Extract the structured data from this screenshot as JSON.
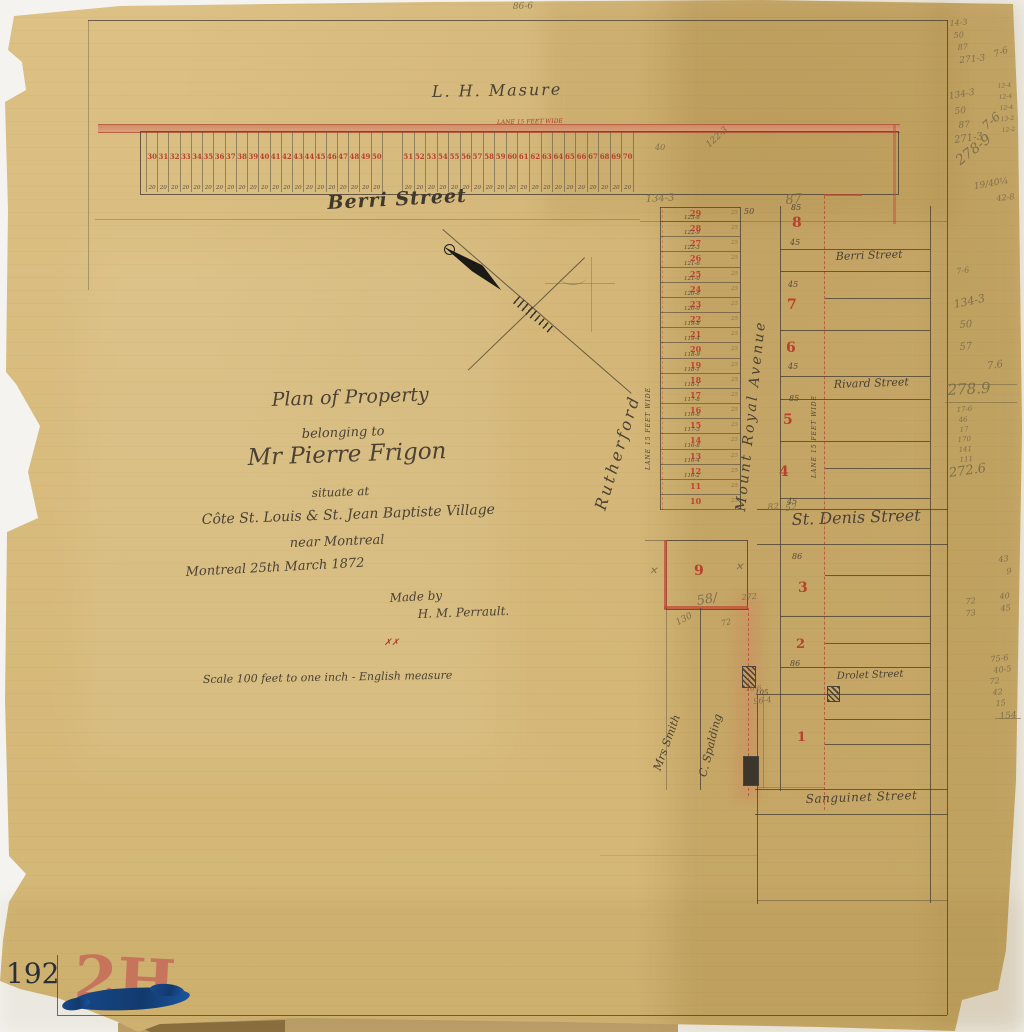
{
  "document": {
    "catalog_number": "192",
    "stamp": "2H"
  },
  "strip": {
    "lane_label": "LANE 15 FEET WIDE",
    "width_label": "20",
    "lots_west": [
      "30",
      "31",
      "32",
      "33",
      "34",
      "35",
      "36",
      "37",
      "38",
      "39",
      "40",
      "41",
      "42",
      "43",
      "44",
      "45",
      "46",
      "47",
      "48",
      "49",
      "50"
    ],
    "lots_east": [
      "51",
      "52",
      "53",
      "54",
      "55",
      "56",
      "57",
      "58",
      "59",
      "60",
      "61",
      "62",
      "63",
      "64",
      "65",
      "66",
      "67",
      "68",
      "69",
      "70"
    ]
  },
  "column": {
    "lane_label": "LANE 15 FEET WIDE",
    "depth_label": "25",
    "lots": [
      {
        "n": "29",
        "d": "123-6"
      },
      {
        "n": "28",
        "d": "122-9"
      },
      {
        "n": "27",
        "d": "122-3"
      },
      {
        "n": "26",
        "d": "121-6"
      },
      {
        "n": "25",
        "d": "121-0"
      },
      {
        "n": "24",
        "d": "120-6"
      },
      {
        "n": "23",
        "d": "120-0"
      },
      {
        "n": "22",
        "d": "119-8"
      },
      {
        "n": "21",
        "d": "119-4"
      },
      {
        "n": "20",
        "d": "118-9"
      },
      {
        "n": "19",
        "d": "118-1"
      },
      {
        "n": "18",
        "d": "118-1"
      },
      {
        "n": "17",
        "d": "117-8"
      },
      {
        "n": "16",
        "d": "116-6"
      },
      {
        "n": "15",
        "d": "117-3"
      },
      {
        "n": "14",
        "d": "116-8"
      },
      {
        "n": "13",
        "d": "116-4"
      },
      {
        "n": "12",
        "d": "116-2"
      },
      {
        "n": "11",
        "d": ""
      },
      {
        "n": "10",
        "d": ""
      }
    ]
  },
  "labels": [
    {
      "t": "L. H. Masure",
      "x": 432,
      "y": 100,
      "s": 16,
      "r": -1,
      "ls": 2,
      "c": "ink",
      "n": "owner-label-masure"
    },
    {
      "t": "LANE 15 FEET WIDE",
      "x": 497,
      "y": 126,
      "s": 6,
      "r": -1,
      "c": "red",
      "n": "strip-lane-label"
    },
    {
      "t": "Berri Street",
      "x": 328,
      "y": 213,
      "s": 19,
      "r": -3,
      "c": "inkb",
      "n": "street-berri-main"
    },
    {
      "t": "Plan of Property",
      "x": 272,
      "y": 410,
      "s": 19,
      "r": -2,
      "c": "ink",
      "n": "title-line-1"
    },
    {
      "t": "belonging to",
      "x": 302,
      "y": 441,
      "s": 13,
      "r": -2,
      "c": "ink",
      "n": "title-line-2"
    },
    {
      "t": "Mr Pierre Frigon",
      "x": 248,
      "y": 470,
      "s": 23,
      "r": -2,
      "c": "ink",
      "n": "title-line-3"
    },
    {
      "t": "situate at",
      "x": 312,
      "y": 499,
      "s": 12,
      "r": -2,
      "c": "ink",
      "n": "title-line-4"
    },
    {
      "t": "Côte St. Louis & St. Jean Baptiste Village",
      "x": 202,
      "y": 527,
      "s": 14,
      "r": -2,
      "c": "ink",
      "n": "title-line-5"
    },
    {
      "t": "near Montreal",
      "x": 290,
      "y": 550,
      "s": 13,
      "r": -2,
      "c": "ink",
      "n": "title-line-6"
    },
    {
      "t": "Montreal 25th March 1872",
      "x": 186,
      "y": 579,
      "s": 13,
      "r": -3,
      "c": "ink",
      "n": "date-line"
    },
    {
      "t": "Made by",
      "x": 390,
      "y": 604,
      "s": 12,
      "r": -3,
      "c": "ink",
      "n": "made-by-label"
    },
    {
      "t": "H. M. Perrault.",
      "x": 418,
      "y": 620,
      "s": 12,
      "r": -2,
      "c": "ink",
      "n": "maker-name"
    },
    {
      "t": "✗✗",
      "x": 384,
      "y": 648,
      "s": 9,
      "r": 0,
      "c": "red",
      "n": "red-check-marks"
    },
    {
      "t": "Scale 100 feet to one inch - English measure",
      "x": 203,
      "y": 685,
      "s": 11,
      "r": -1,
      "c": "ink",
      "n": "scale-note"
    },
    {
      "t": "Rutherford",
      "x": 608,
      "y": 512,
      "s": 16,
      "r": -73,
      "ls": 3,
      "c": "ink",
      "n": "owner-rutherford"
    },
    {
      "t": "Mount Royal Avenue",
      "x": 748,
      "y": 512,
      "s": 14,
      "r": -84,
      "ls": 2.5,
      "c": "ink",
      "n": "street-mount-royal-avenue"
    },
    {
      "t": "LANE 15 FEET WIDE",
      "x": 652,
      "y": 470,
      "s": 6,
      "r": -90,
      "ls": 1,
      "c": "ink",
      "n": "column-lane-label"
    },
    {
      "t": "LANE 15 FEET WIDE",
      "x": 818,
      "y": 478,
      "s": 6,
      "r": -90,
      "ls": 1,
      "c": "ink",
      "n": "east-lane-label"
    },
    {
      "t": "Mrs Smith",
      "x": 662,
      "y": 772,
      "s": 11,
      "r": -70,
      "c": "ink",
      "n": "owner-mrs-smith"
    },
    {
      "t": "C. Spalding",
      "x": 708,
      "y": 778,
      "s": 11,
      "r": -76,
      "c": "ink",
      "n": "owner-c-spalding"
    },
    {
      "t": "Berri Street",
      "x": 836,
      "y": 262,
      "s": 11,
      "r": -2,
      "c": "ink",
      "n": "street-berri-east"
    },
    {
      "t": "Rivard Street",
      "x": 834,
      "y": 390,
      "s": 11,
      "r": -2,
      "c": "ink",
      "n": "street-rivard"
    },
    {
      "t": "St. Denis Street",
      "x": 792,
      "y": 528,
      "s": 16,
      "r": -2,
      "c": "ink",
      "n": "street-st-denis"
    },
    {
      "t": "Drolet Street",
      "x": 837,
      "y": 682,
      "s": 10,
      "r": -2,
      "c": "ink",
      "n": "street-drolet"
    },
    {
      "t": "Sanguinet Street",
      "x": 806,
      "y": 805,
      "s": 12,
      "r": -2,
      "ls": 0.5,
      "c": "ink",
      "n": "street-sanguinet"
    },
    {
      "t": "9",
      "x": 694,
      "y": 578,
      "s": 14,
      "r": 0,
      "c": "rnum",
      "n": "lot-9"
    },
    {
      "t": "8",
      "x": 792,
      "y": 230,
      "s": 14,
      "r": 0,
      "c": "rnum",
      "n": "lot-8"
    },
    {
      "t": "7",
      "x": 787,
      "y": 312,
      "s": 14,
      "r": 0,
      "c": "rnum",
      "n": "lot-7"
    },
    {
      "t": "6",
      "x": 786,
      "y": 355,
      "s": 14,
      "r": 0,
      "c": "rnum",
      "n": "lot-6"
    },
    {
      "t": "5",
      "x": 783,
      "y": 427,
      "s": 14,
      "r": 0,
      "c": "rnum",
      "n": "lot-5"
    },
    {
      "t": "4",
      "x": 779,
      "y": 479,
      "s": 14,
      "r": 0,
      "c": "rnum",
      "n": "lot-4"
    },
    {
      "t": "3",
      "x": 798,
      "y": 595,
      "s": 14,
      "r": 0,
      "c": "rnum",
      "n": "lot-3"
    },
    {
      "t": "2",
      "x": 796,
      "y": 651,
      "s": 13,
      "r": 0,
      "c": "rnum",
      "n": "lot-2"
    },
    {
      "t": "1",
      "x": 797,
      "y": 744,
      "s": 13,
      "r": 0,
      "c": "rnum",
      "n": "lot-1"
    },
    {
      "t": "85",
      "x": 791,
      "y": 212,
      "s": 8,
      "r": 0,
      "c": "dim",
      "n": "dim-85"
    },
    {
      "t": "45",
      "x": 790,
      "y": 247,
      "s": 8,
      "r": 0,
      "c": "dim",
      "n": "dim-45"
    },
    {
      "t": "45",
      "x": 788,
      "y": 289,
      "s": 8,
      "r": 0,
      "c": "dim",
      "n": "dim-45"
    },
    {
      "t": "45",
      "x": 788,
      "y": 371,
      "s": 8,
      "r": 0,
      "c": "dim",
      "n": "dim-45"
    },
    {
      "t": "85",
      "x": 789,
      "y": 403,
      "s": 8,
      "r": 0,
      "c": "dim",
      "n": "dim-85"
    },
    {
      "t": "45",
      "x": 787,
      "y": 506,
      "s": 8,
      "r": 0,
      "c": "dim",
      "n": "dim-45"
    },
    {
      "t": "86",
      "x": 792,
      "y": 561,
      "s": 8,
      "r": 0,
      "c": "dim",
      "n": "dim-86"
    },
    {
      "t": "86",
      "x": 790,
      "y": 668,
      "s": 8,
      "r": 0,
      "c": "dim",
      "n": "dim-86"
    },
    {
      "t": "105",
      "x": 755,
      "y": 697,
      "s": 7,
      "r": 0,
      "c": "dim",
      "n": "dim-105"
    },
    {
      "t": "50",
      "x": 744,
      "y": 216,
      "s": 8,
      "r": 0,
      "c": "dim",
      "n": "dim-50"
    },
    {
      "t": "86-6",
      "x": 513,
      "y": 12,
      "s": 9,
      "r": -2,
      "c": "pencil",
      "n": "pencil-top-edge"
    },
    {
      "t": "122-3",
      "x": 711,
      "y": 150,
      "s": 9,
      "r": -42,
      "c": "pencil",
      "n": "pencil-strip-right"
    },
    {
      "t": "40",
      "x": 655,
      "y": 152,
      "s": 8,
      "r": 0,
      "c": "pencil",
      "n": "pencil-40"
    },
    {
      "t": "134-3",
      "x": 646,
      "y": 205,
      "s": 10,
      "r": -3,
      "c": "pencil",
      "n": "pencil-134-3"
    },
    {
      "t": "87",
      "x": 786,
      "y": 207,
      "s": 13,
      "r": -5,
      "c": "pencil",
      "n": "pencil-87-large"
    },
    {
      "t": "82",
      "x": 768,
      "y": 513,
      "s": 9,
      "r": -4,
      "c": "pencil",
      "n": "pencil-82"
    },
    {
      "t": "52",
      "x": 786,
      "y": 514,
      "s": 9,
      "r": -6,
      "c": "pencil",
      "n": "pencil-52"
    },
    {
      "t": "✕",
      "x": 649,
      "y": 577,
      "s": 10,
      "r": 0,
      "c": "pencil",
      "n": "pencil-x-mark"
    },
    {
      "t": "✕",
      "x": 735,
      "y": 573,
      "s": 10,
      "r": 0,
      "c": "pencil",
      "n": "pencil-x-mark"
    },
    {
      "t": "58/",
      "x": 698,
      "y": 608,
      "s": 13,
      "r": -10,
      "c": "pencil",
      "n": "pencil-58"
    },
    {
      "t": "272",
      "x": 742,
      "y": 602,
      "s": 8,
      "r": -5,
      "c": "pencil",
      "n": "pencil-272"
    },
    {
      "t": "130",
      "x": 679,
      "y": 628,
      "s": 9,
      "r": -28,
      "c": "pencil",
      "n": "pencil-130"
    },
    {
      "t": "72",
      "x": 722,
      "y": 628,
      "s": 8,
      "r": -12,
      "c": "pencil",
      "n": "pencil-72"
    },
    {
      "t": "16-6",
      "x": 746,
      "y": 693,
      "s": 7,
      "r": -4,
      "c": "pencil",
      "n": "pencil-16-6"
    },
    {
      "t": "96-4",
      "x": 754,
      "y": 706,
      "s": 8,
      "r": -6,
      "c": "pencil",
      "n": "pencil-96-4"
    },
    {
      "t": "14-3",
      "x": 950,
      "y": 28,
      "s": 8,
      "r": -5,
      "c": "pencil",
      "n": "margin-pencil"
    },
    {
      "t": "50",
      "x": 954,
      "y": 40,
      "s": 8,
      "r": -4,
      "c": "pencil",
      "n": "margin-pencil"
    },
    {
      "t": "87",
      "x": 958,
      "y": 52,
      "s": 8,
      "r": -4,
      "c": "pencil",
      "n": "margin-pencil"
    },
    {
      "t": "271-3",
      "x": 960,
      "y": 66,
      "s": 9,
      "r": -6,
      "c": "pencil",
      "n": "margin-pencil"
    },
    {
      "t": "7-6",
      "x": 996,
      "y": 60,
      "s": 9,
      "r": -20,
      "c": "pencil",
      "n": "margin-pencil"
    },
    {
      "t": "134-3",
      "x": 950,
      "y": 102,
      "s": 9,
      "r": -10,
      "c": "pencil",
      "n": "margin-pencil"
    },
    {
      "t": "50",
      "x": 955,
      "y": 117,
      "s": 9,
      "r": -5,
      "c": "pencil",
      "n": "margin-pencil"
    },
    {
      "t": "87",
      "x": 959,
      "y": 131,
      "s": 9,
      "r": -5,
      "c": "pencil",
      "n": "margin-pencil"
    },
    {
      "t": "271-3",
      "x": 955,
      "y": 146,
      "s": 10,
      "r": -8,
      "c": "pencil",
      "n": "margin-pencil"
    },
    {
      "t": "7-6",
      "x": 988,
      "y": 132,
      "s": 12,
      "r": -42,
      "c": "pencil",
      "n": "margin-pencil"
    },
    {
      "t": "278-9",
      "x": 962,
      "y": 168,
      "s": 14,
      "r": -38,
      "c": "pencil",
      "n": "margin-pencil"
    },
    {
      "t": "12-4",
      "x": 998,
      "y": 90,
      "s": 6,
      "r": -5,
      "c": "pencil",
      "n": "margin-pencil"
    },
    {
      "t": "12-4",
      "x": 999,
      "y": 101,
      "s": 6,
      "r": -5,
      "c": "pencil",
      "n": "margin-pencil"
    },
    {
      "t": "12-4",
      "x": 1000,
      "y": 112,
      "s": 6,
      "r": -5,
      "c": "pencil",
      "n": "margin-pencil"
    },
    {
      "t": "13-2",
      "x": 1001,
      "y": 123,
      "s": 6,
      "r": -5,
      "c": "pencil",
      "n": "margin-pencil"
    },
    {
      "t": "12-2",
      "x": 1002,
      "y": 134,
      "s": 6,
      "r": -5,
      "c": "pencil",
      "n": "margin-pencil"
    },
    {
      "t": "19/40¼",
      "x": 975,
      "y": 192,
      "s": 9,
      "r": -10,
      "c": "pencil",
      "n": "margin-pencil"
    },
    {
      "t": "42-8",
      "x": 997,
      "y": 203,
      "s": 8,
      "r": -6,
      "c": "pencil",
      "n": "margin-pencil"
    },
    {
      "t": "7-6",
      "x": 957,
      "y": 276,
      "s": 8,
      "r": -8,
      "c": "pencil",
      "n": "margin-pencil"
    },
    {
      "t": "134-3",
      "x": 955,
      "y": 310,
      "s": 11,
      "r": -12,
      "c": "pencil",
      "n": "margin-pencil"
    },
    {
      "t": "50",
      "x": 960,
      "y": 331,
      "s": 10,
      "r": -5,
      "c": "pencil",
      "n": "margin-pencil"
    },
    {
      "t": "57",
      "x": 960,
      "y": 353,
      "s": 10,
      "r": -5,
      "c": "pencil",
      "n": "margin-pencil"
    },
    {
      "t": "7.6",
      "x": 988,
      "y": 372,
      "s": 10,
      "r": -8,
      "c": "pencil",
      "n": "margin-pencil"
    },
    {
      "t": "278.9",
      "x": 948,
      "y": 398,
      "s": 15,
      "r": -3,
      "c": "pencil",
      "n": "margin-pencil-sum"
    },
    {
      "t": "17-6",
      "x": 957,
      "y": 414,
      "s": 7,
      "r": -5,
      "c": "pencil",
      "n": "margin-pencil"
    },
    {
      "t": "46",
      "x": 959,
      "y": 424,
      "s": 7,
      "r": -5,
      "c": "pencil",
      "n": "margin-pencil"
    },
    {
      "t": "17",
      "x": 960,
      "y": 434,
      "s": 7,
      "r": -5,
      "c": "pencil",
      "n": "margin-pencil"
    },
    {
      "t": "170",
      "x": 958,
      "y": 444,
      "s": 7,
      "r": -5,
      "c": "pencil",
      "n": "margin-pencil"
    },
    {
      "t": "141",
      "x": 959,
      "y": 454,
      "s": 7,
      "r": -5,
      "c": "pencil",
      "n": "margin-pencil"
    },
    {
      "t": "111",
      "x": 960,
      "y": 464,
      "s": 7,
      "r": -5,
      "c": "pencil",
      "n": "margin-pencil"
    },
    {
      "t": "272.6",
      "x": 950,
      "y": 480,
      "s": 13,
      "r": -8,
      "c": "pencil",
      "n": "margin-pencil-sum"
    },
    {
      "t": "43",
      "x": 999,
      "y": 564,
      "s": 8,
      "r": -6,
      "c": "pencil",
      "n": "margin-pencil"
    },
    {
      "t": "9",
      "x": 1007,
      "y": 576,
      "s": 8,
      "r": -6,
      "c": "pencil",
      "n": "margin-pencil"
    },
    {
      "t": "72",
      "x": 966,
      "y": 606,
      "s": 8,
      "r": -5,
      "c": "pencil",
      "n": "margin-pencil"
    },
    {
      "t": "73",
      "x": 966,
      "y": 618,
      "s": 8,
      "r": -5,
      "c": "pencil",
      "n": "margin-pencil"
    },
    {
      "t": "40",
      "x": 1000,
      "y": 601,
      "s": 8,
      "r": -5,
      "c": "pencil",
      "n": "margin-pencil"
    },
    {
      "t": "45",
      "x": 1001,
      "y": 613,
      "s": 8,
      "r": -5,
      "c": "pencil",
      "n": "margin-pencil"
    },
    {
      "t": "75-6",
      "x": 991,
      "y": 664,
      "s": 8,
      "r": -6,
      "c": "pencil",
      "n": "margin-pencil"
    },
    {
      "t": "40-5",
      "x": 994,
      "y": 675,
      "s": 8,
      "r": -6,
      "c": "pencil",
      "n": "margin-pencil"
    },
    {
      "t": "72",
      "x": 990,
      "y": 686,
      "s": 8,
      "r": -5,
      "c": "pencil",
      "n": "margin-pencil"
    },
    {
      "t": "42",
      "x": 993,
      "y": 697,
      "s": 8,
      "r": -5,
      "c": "pencil",
      "n": "margin-pencil"
    },
    {
      "t": "15",
      "x": 996,
      "y": 708,
      "s": 8,
      "r": -5,
      "c": "pencil",
      "n": "margin-pencil"
    },
    {
      "t": "154",
      "x": 1000,
      "y": 722,
      "s": 9,
      "r": -5,
      "c": "pencil",
      "n": "margin-pencil-sum"
    }
  ]
}
